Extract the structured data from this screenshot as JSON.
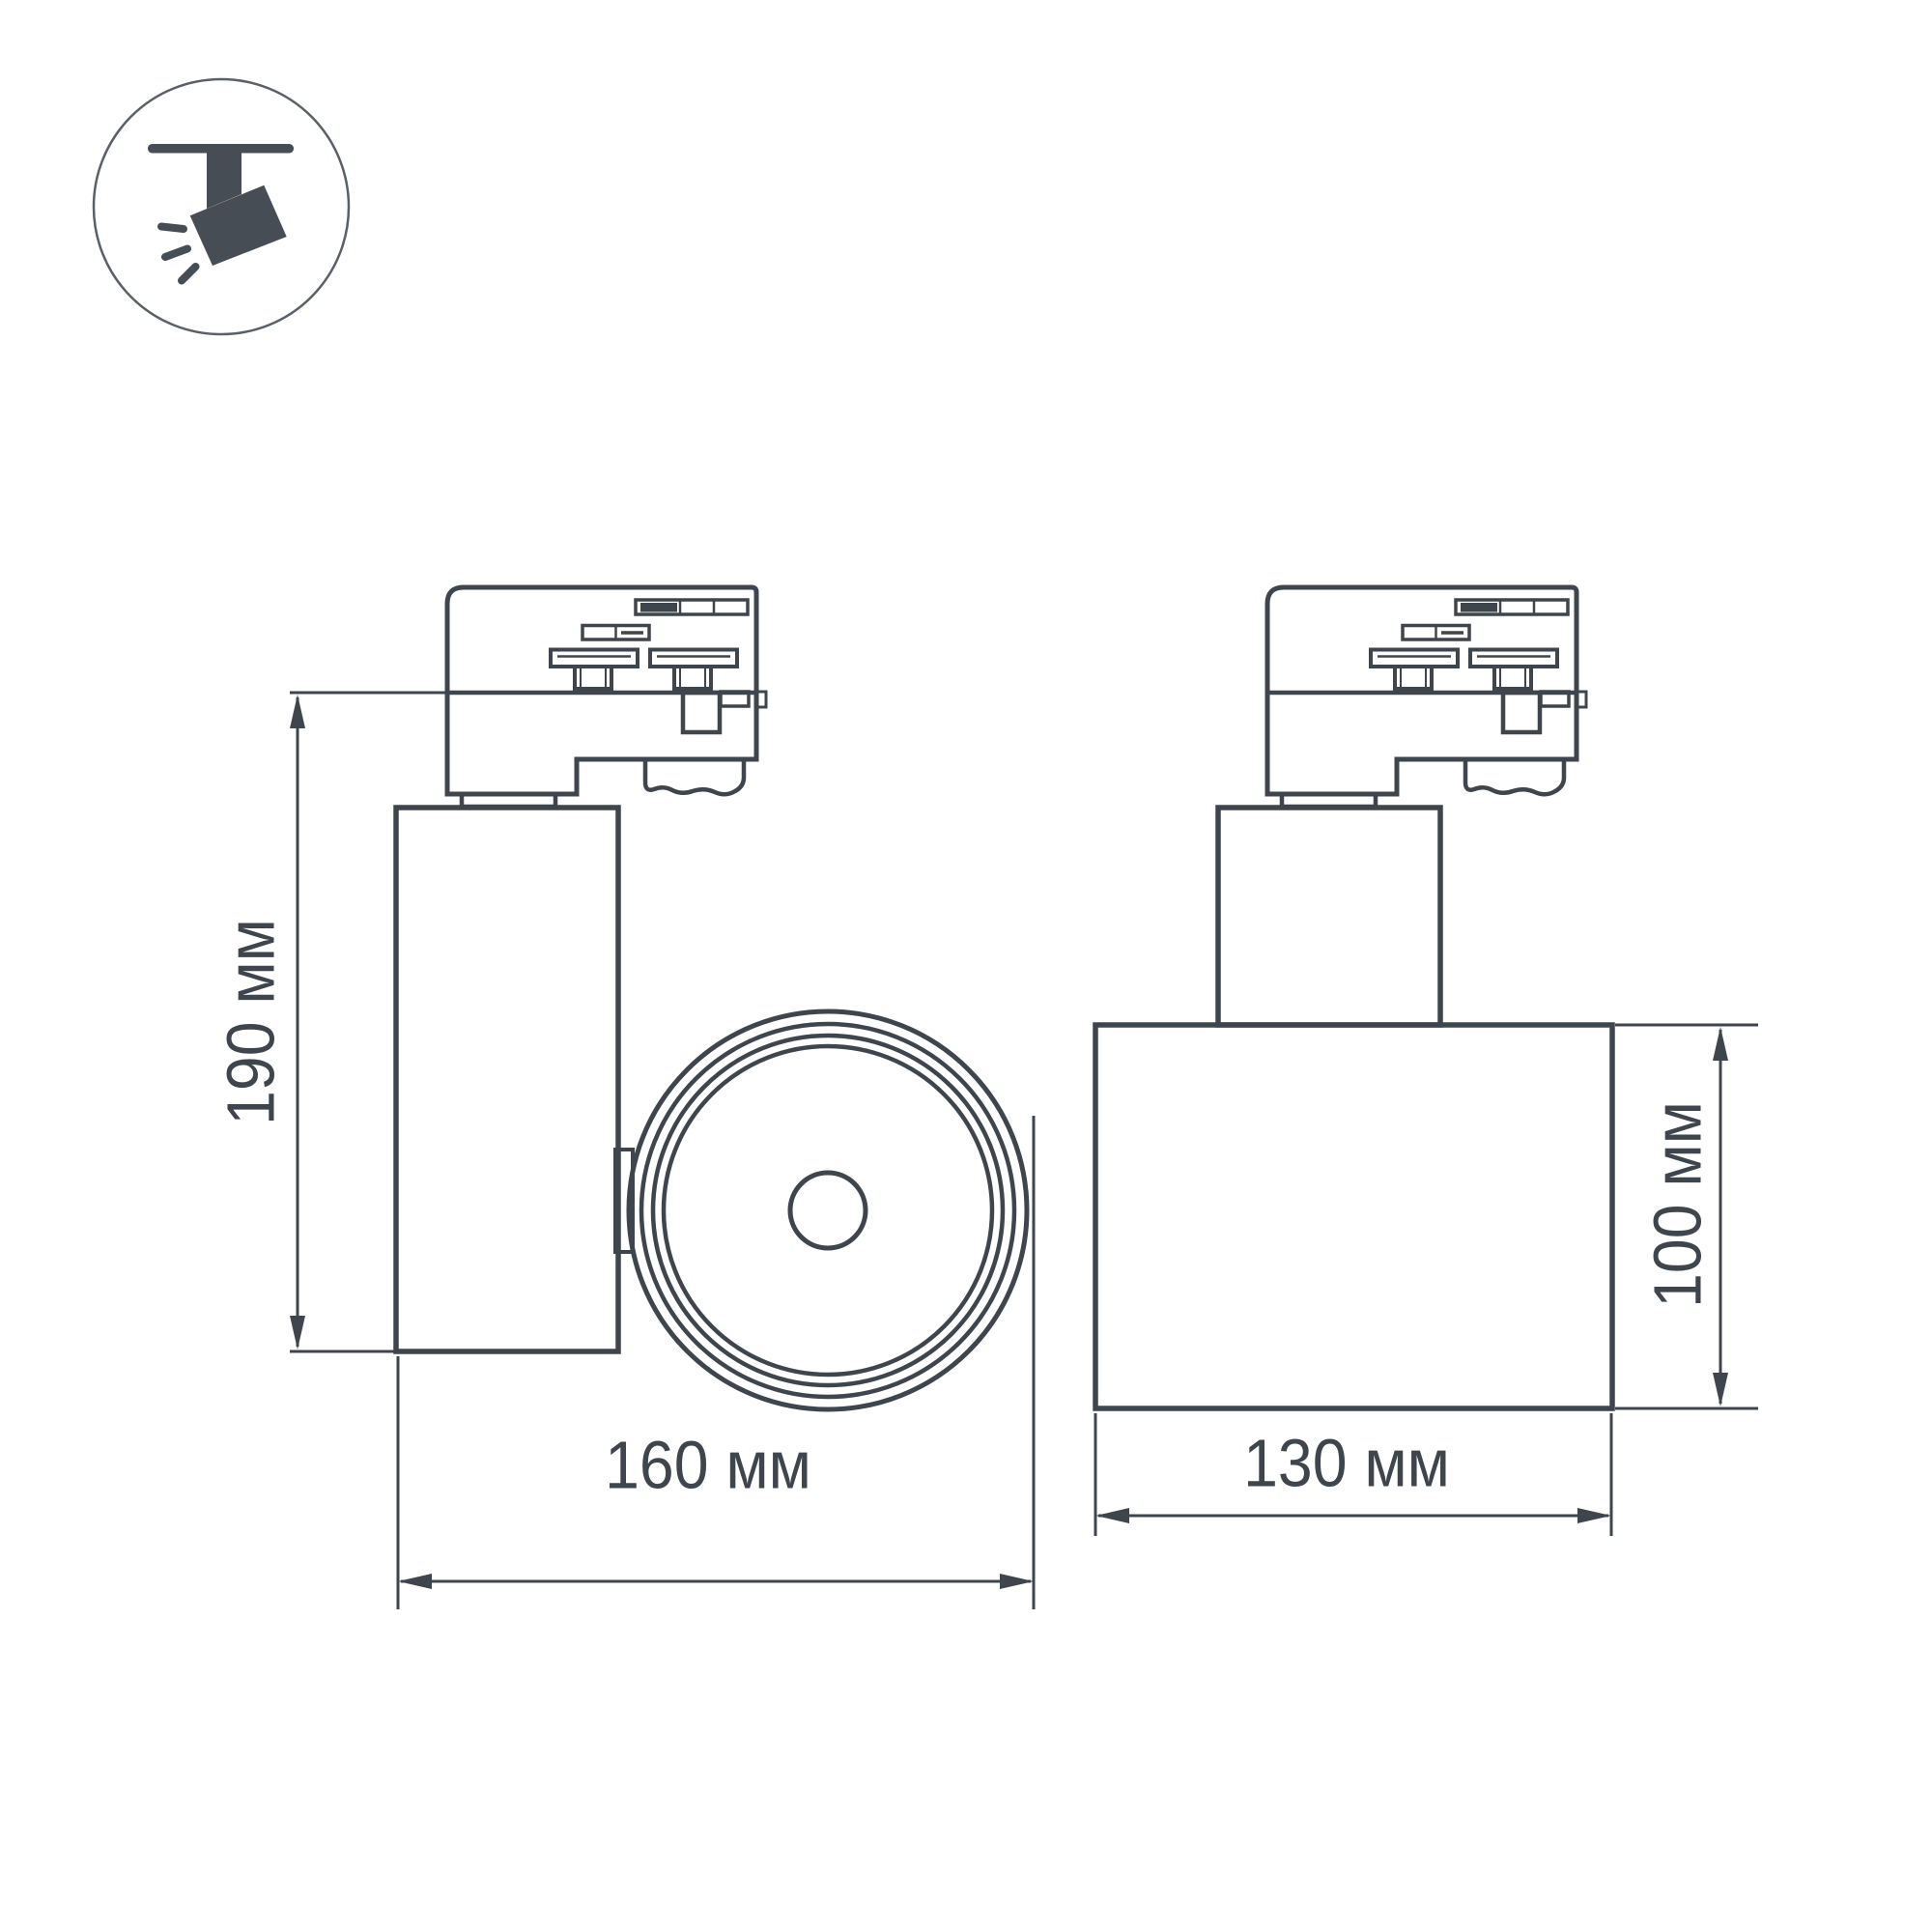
{
  "page": {
    "background": "#FFFFFF"
  },
  "colors": {
    "line": "#3F454C",
    "icon_fill": "#474D55",
    "icon_ring": "#5A6067"
  },
  "icon": {
    "name": "track-spotlight-icon"
  },
  "views": {
    "side": {
      "height_label": "190 мм",
      "width_label": "160 мм"
    },
    "front": {
      "height_label": "100 мм",
      "width_label": "130 мм"
    }
  }
}
